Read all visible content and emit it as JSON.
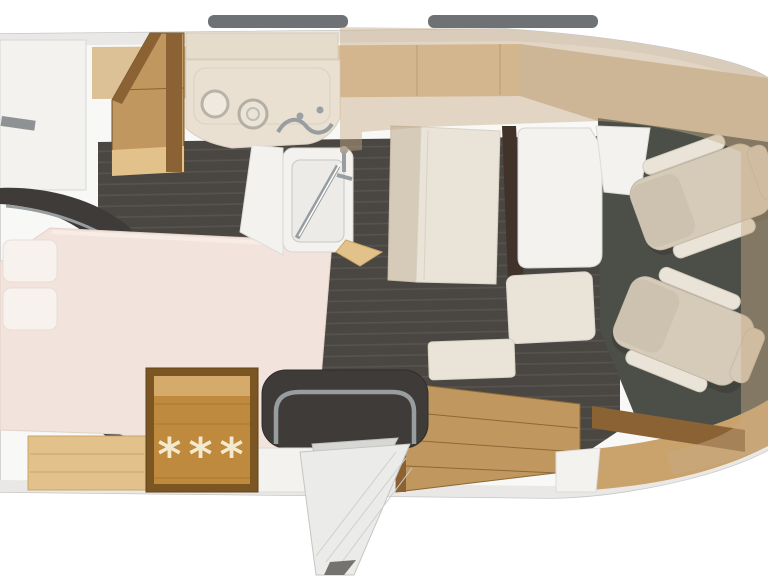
{
  "meta": {
    "title": "Motorhome floor plan - top view render",
    "view": "overhead 3D floor plan of a camper van, front of vehicle on the right"
  },
  "fridge": {
    "symbols": "***",
    "symbol_count": 3,
    "meaning": "snowflake markings on refrigerator cabinet"
  },
  "palette": {
    "page-bg": "#ffffff",
    "body": "#f8f8f7",
    "outline": "#c8c7c5",
    "wall-band": "#e9e8e6",
    "roof-bar": "#6f7274",
    "cabinet-band": "#dcc096",
    "tan-nose": "#d0bfa2",
    "floor-dark": "#4a4642",
    "floor-stripe": "#575350",
    "cab-floor": "#4c4f47",
    "wood": "#c0975f",
    "wood-dark": "#8a6234",
    "wood-light": "#e3c18a",
    "fridge-wood": "#c08a3e",
    "fridge-frame": "#7c5622",
    "star": "#f5e9cd",
    "mattress": "#f2e3dc",
    "pillow": "#f7f2ee",
    "seat": "#d6cab9",
    "seat-light": "#e9e3d8",
    "white-furniture": "#f3f2ef",
    "chrome": "#989da0",
    "dark-block": "#3e3b38",
    "overlay": "rgba(200,170,134,0.45)",
    "dash-wood": "#c9a26c"
  }
}
